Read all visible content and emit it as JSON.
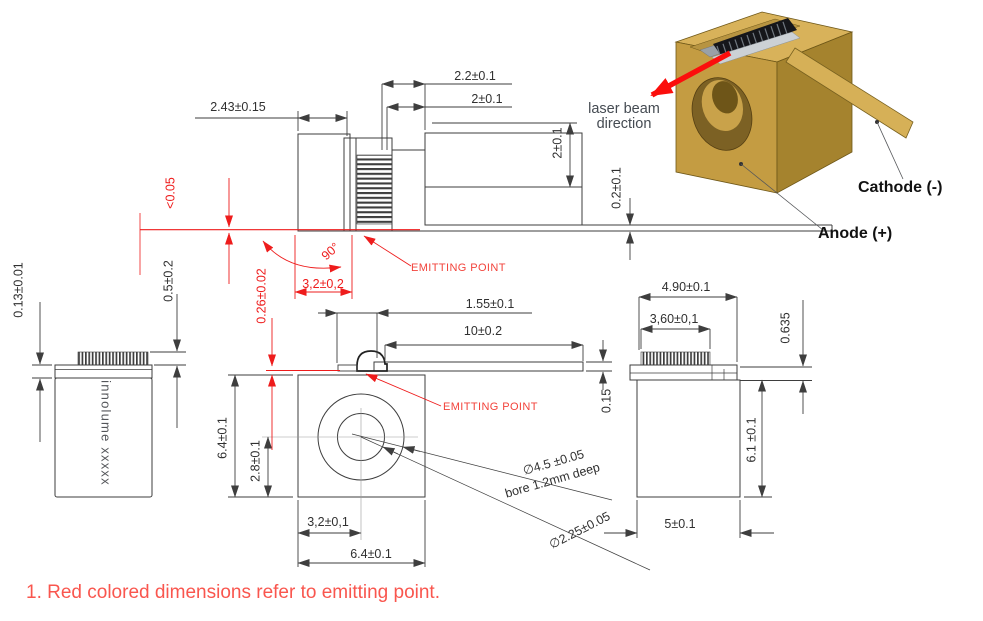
{
  "colors": {
    "dimension_red": "#ee1c1c",
    "note_red": "#f9564e",
    "drawing_line": "#3e3e3e",
    "gold_top": "#d8b25a",
    "gold_front": "#c49c42",
    "gold_side": "#a5832e",
    "beam_arrow_red": "#fb0e0c"
  },
  "note": "1. Red colored dimensions refer to emitting point.",
  "iso_view": {
    "beam_label": "laser beam direction",
    "cathode_label": "Cathode (-)",
    "anode_label": "Anode (+)"
  },
  "top_view": {
    "body_width": "2.43±0.15",
    "chip_width": "2.2±0.1",
    "chip_to_edge": "2±0.1",
    "lead_width": "2±0.1",
    "tail_thickness": "0.2±0.1",
    "flatness": "<0.05",
    "facet_angle": "90°",
    "emitter_offset": "3,2±0,2",
    "emitting_point": "EMITTING POINT"
  },
  "left_view": {
    "marking": "innolume xxxxx",
    "plate_thickness": "0.13±0.01",
    "chip_height": "0.5±0.2"
  },
  "front_view": {
    "emitter_height": "0.26±0.02",
    "lead_inset": "1.55±0.1",
    "lead_length": "10±0.2",
    "emitting_point": "EMITTING POINT",
    "lead_thickness": "0.15",
    "body_height": "6.4±0.1",
    "bore_center_height": "2.8±0.1",
    "bore_center_offset": "3,2±0,1",
    "body_width": "6.4±0.1",
    "bore_diameter": "∅4.5 ±0.05",
    "bore_depth": "bore 1.2mm deep",
    "hole_diameter": "∅2.25±0.05"
  },
  "right_view": {
    "top_width": "4.90±0.1",
    "chip_width": "3,60±0,1",
    "submount_thickness": "0.635",
    "body_height": "6.1 ±0.1",
    "body_width": "5±0.1"
  }
}
